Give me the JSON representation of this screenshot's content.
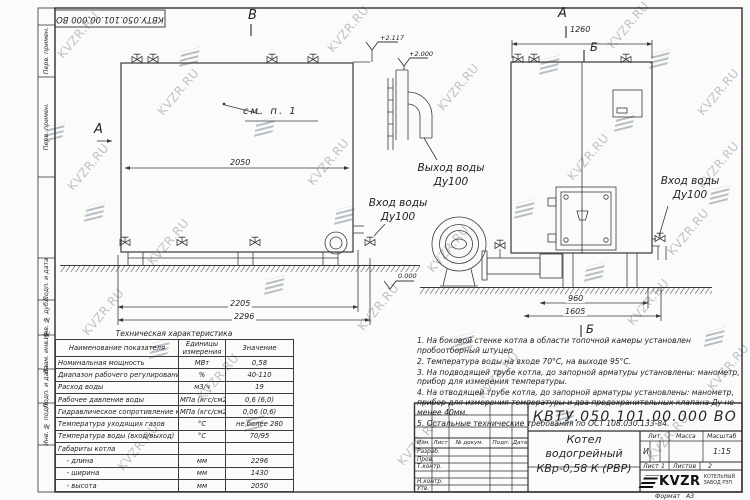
{
  "watermark": {
    "text": "KVZR.RU"
  },
  "corner_stamp": "КВТУ.050.101.00.000  ВО",
  "margin_labels": {
    "top": [
      "Перв. примен.",
      "Перв. примен."
    ],
    "bottom": [
      "Подп. и дата",
      "Инв. № дубл.",
      "Взам. инв. №",
      "Подп. и дата",
      "Инв. № подл."
    ]
  },
  "views": {
    "left": {
      "section_top": "В",
      "section_side": "А",
      "see_note": "см. п. 1",
      "dims": {
        "inner_width": "2050",
        "base_width": "2205",
        "total_width": "2296"
      },
      "elevations": {
        "top1": "+2.117",
        "top2": "+2.000",
        "zero": "0.000"
      },
      "outlet_label": "Выход воды",
      "outlet_dn": "Ду100",
      "inlet_label": "Вход воды",
      "inlet_dn": "Ду100"
    },
    "right": {
      "section_top": "А",
      "section_b_top": "Б",
      "section_b_bottom": "Б",
      "dims": {
        "top_width": "1260",
        "base_depth": "960",
        "total_depth": "1605"
      },
      "inlet_label": "Вход воды",
      "inlet_dn": "Ду100"
    }
  },
  "tech_table": {
    "title": "Техническая характеристика",
    "headers": [
      "Наименование показателя",
      "Единицы измерения",
      "Значение"
    ],
    "rows": [
      [
        "Номинальная мощность",
        "МВт",
        "0,58"
      ],
      [
        "Диапазон рабочего регулирования",
        "%",
        "40-110"
      ],
      [
        "Расход воды",
        "м3/ч",
        "19"
      ],
      [
        "Рабочее давление воды",
        "МПа (кгс/см2)",
        "0,6 (6,0)"
      ],
      [
        "Гидравлическое сопротивление котла",
        "МПа (кгс/см2)",
        "0,06 (0,6)"
      ],
      [
        "Температура уходящих газов",
        "°С",
        "не более 280"
      ],
      [
        "Температура воды (вход/выход)",
        "°С",
        "70/95"
      ],
      [
        "Габариты котла",
        "",
        ""
      ],
      [
        "    - длина",
        "мм",
        "2296"
      ],
      [
        "    - ширина",
        "мм",
        "1430"
      ],
      [
        "    - высота",
        "мм",
        "2050"
      ]
    ]
  },
  "notes": [
    "1.  На боковой стенке котла в области топочной камеры установлен пробоотборный штуцер",
    "2.  Температура воды на входе  70°С, на выходе  95°С.",
    "3.  На подводящей трубе котла, до запорной арматуры установлены: манометр, прибор для измерения температуры.",
    "4.  На отводящей трубе котла, до запорной арматуры установлены: манометр, прибор для измерения температуры и два предохранительных клапана  Ду не менее  40мм.",
    "5.  Остальные технические требования по ОСТ  108.030.133-84."
  ],
  "title_block": {
    "doc_number": "КВТУ.050.101.00.000  ВО",
    "product_name_line1": "Котел водогрейный",
    "product_name_line2": "КВр-0,58  К  (РВР)",
    "header_cells": [
      "Изм.",
      "Лист",
      "№ докум.",
      "Подп.",
      "Дата"
    ],
    "row_labels": [
      "Разраб.",
      "Пров.",
      "Т.контр.",
      "",
      "Н.контр.",
      "Утв."
    ],
    "lit_label": "Лит.",
    "lit_value": "И",
    "mass_label": "Масса",
    "scale_label": "Масштаб",
    "scale_value": "1:15",
    "sheet_label": "Лист",
    "sheet_value": "1",
    "sheets_label": "Листов",
    "sheets_value": "2",
    "logo_text": "KVZR",
    "logo_caption_line1": "КОТЕЛЬНЫЙ",
    "logo_caption_line2": "ЗАВОД РЭП"
  },
  "format": {
    "label": "Формат",
    "value": "А3"
  }
}
